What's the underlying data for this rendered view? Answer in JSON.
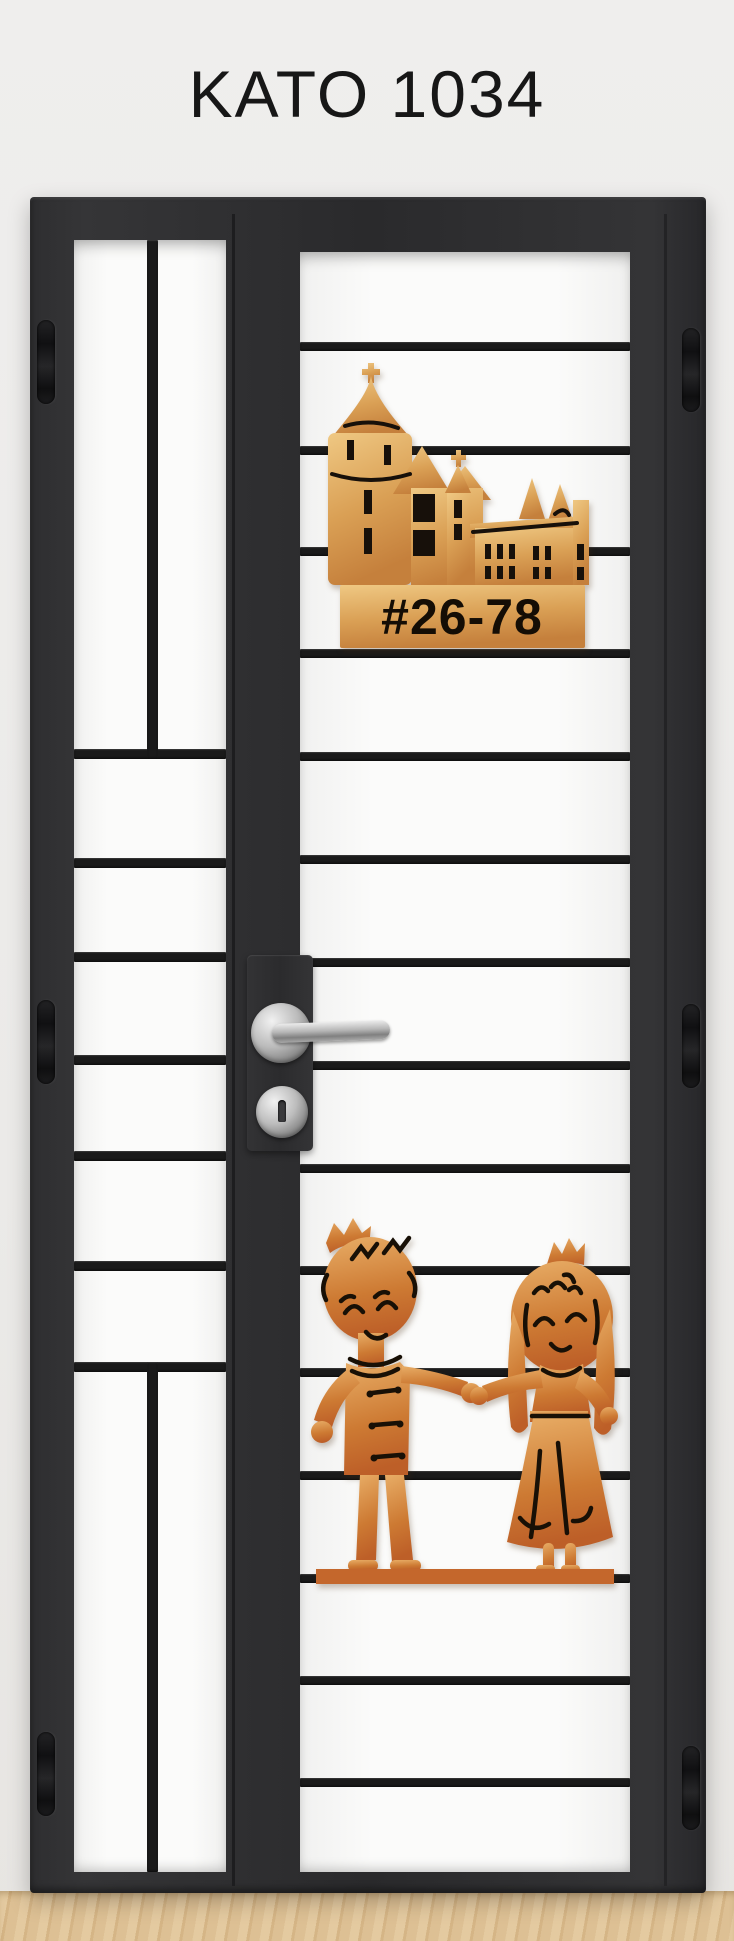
{
  "page": {
    "title": "KATO 1034"
  },
  "gate": {
    "unit_number": "#26-78",
    "emblems": {
      "castle": "castle-emblem",
      "couple": "prince-princess-emblem"
    },
    "hardware": {
      "handle": "lever-handle",
      "lock": "key-cylinder",
      "hinge": "barrel-hinge"
    }
  },
  "colors": {
    "wall": "#edecea",
    "frame_dark": "#2c2c2e",
    "bar_black": "#1a1a1a",
    "panel_white": "#f8f8f7",
    "copper_light": "#eabf76",
    "copper_mid": "#d08b44",
    "copper_dark": "#bc6026",
    "chrome": "#c9c9c9",
    "floor_wood": "#dcbd92",
    "title_ink": "#171717",
    "detail_ink": "#17100a"
  }
}
